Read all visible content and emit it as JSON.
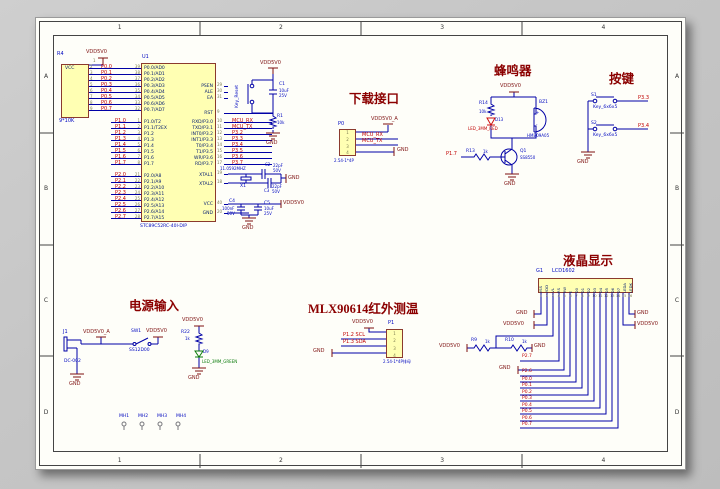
{
  "sheet": {
    "zones_top": [
      "1",
      "2",
      "3",
      "4"
    ],
    "zones_bottom": [
      "1",
      "2",
      "3",
      "4"
    ],
    "zones_left": [
      "A",
      "B",
      "C",
      "D"
    ],
    "zones_right": [
      "A",
      "B",
      "C",
      "D"
    ]
  },
  "colors": {
    "wire": "#0000A6",
    "power": "#7D1010",
    "net": "#C00000",
    "designator": "#0008C0",
    "body_fill": "#FFFFB3",
    "body_border": "#8B3A2E",
    "title": "#8B0000"
  },
  "titles": {
    "download": "下载接口",
    "buzzer": "蜂鸣器",
    "keys": "按键",
    "lcd": "液晶显示",
    "mlx": "MLX90614红外测温",
    "power": "电源输入"
  },
  "mcu": {
    "designator": "U1",
    "part": "STC89C52RC-40I-DIP",
    "p0": [
      {
        "num": "39",
        "name": "P0.0/AD0",
        "net": "P0.0"
      },
      {
        "num": "38",
        "name": "P0.1/AD1",
        "net": "P0.1"
      },
      {
        "num": "37",
        "name": "P0.2/AD2",
        "net": "P0.2"
      },
      {
        "num": "36",
        "name": "P0.3/AD3",
        "net": "P0.3"
      },
      {
        "num": "35",
        "name": "P0.4/AD4",
        "net": "P0.4"
      },
      {
        "num": "34",
        "name": "P0.5/AD5",
        "net": "P0.5"
      },
      {
        "num": "33",
        "name": "P0.6/AD6",
        "net": "P0.6"
      },
      {
        "num": "32",
        "name": "P0.7/AD7",
        "net": "P0.7"
      }
    ],
    "p1": [
      {
        "num": "1",
        "name": "P1.0/T2",
        "net": "P1.0"
      },
      {
        "num": "2",
        "name": "P1.1/T2EX",
        "net": "P1.1"
      },
      {
        "num": "3",
        "name": "P1.2",
        "net": "P1.2"
      },
      {
        "num": "4",
        "name": "P1.3",
        "net": "P1.3"
      },
      {
        "num": "5",
        "name": "P1.4",
        "net": "P1.4"
      },
      {
        "num": "6",
        "name": "P1.5",
        "net": "P1.5"
      },
      {
        "num": "7",
        "name": "P1.6",
        "net": "P1.6"
      },
      {
        "num": "8",
        "name": "P1.7",
        "net": "P1.7"
      }
    ],
    "p2": [
      {
        "num": "21",
        "name": "P2.0/A8",
        "net": "P2.0"
      },
      {
        "num": "22",
        "name": "P2.1/A9",
        "net": "P2.1"
      },
      {
        "num": "23",
        "name": "P2.2/A10",
        "net": "P2.2"
      },
      {
        "num": "24",
        "name": "P2.3/A11",
        "net": "P2.3"
      },
      {
        "num": "25",
        "name": "P2.4/A12",
        "net": "P2.4"
      },
      {
        "num": "26",
        "name": "P2.5/A13",
        "net": "P2.5"
      },
      {
        "num": "27",
        "name": "P2.6/A14",
        "net": "P2.6"
      },
      {
        "num": "28",
        "name": "P2.7/A15",
        "net": "P2.7"
      }
    ],
    "ctrl": [
      {
        "num": "29",
        "name": "PSEN"
      },
      {
        "num": "30",
        "name": "ALE"
      },
      {
        "num": "31",
        "name": "EA"
      }
    ],
    "rst": {
      "num": "9",
      "name": "RST"
    },
    "p3": [
      {
        "num": "10",
        "name": "RXD/P3.0",
        "net": "MCU_RX"
      },
      {
        "num": "11",
        "name": "TXD/P3.1",
        "net": "MCU_TX"
      },
      {
        "num": "12",
        "name": "INT0/P3.2",
        "net": "P3.2"
      },
      {
        "num": "13",
        "name": "INT1/P3.3",
        "net": "P3.3"
      },
      {
        "num": "14",
        "name": "T0/P3.4",
        "net": "P3.4"
      },
      {
        "num": "15",
        "name": "T1/P3.5",
        "net": "P3.5"
      },
      {
        "num": "16",
        "name": "WR/P3.6",
        "net": "P3.6"
      },
      {
        "num": "17",
        "name": "RD/P3.7",
        "net": "P3.7"
      }
    ],
    "xtal": [
      {
        "num": "19",
        "name": "XTAL1"
      },
      {
        "num": "18",
        "name": "XTAL2"
      }
    ],
    "pwr": [
      {
        "num": "40",
        "name": "VCC"
      },
      {
        "num": "20",
        "name": "GND"
      }
    ]
  },
  "rpack": {
    "designator": "R4",
    "common_label": "VCC",
    "common_pin": "1",
    "value": "9*10K",
    "pin_nums": [
      "2",
      "3",
      "4",
      "5",
      "6",
      "7",
      "8",
      "9"
    ],
    "power": "VDD5V0"
  },
  "reset": {
    "key_name": "Key_Reset",
    "power": "VDD5V0",
    "cap": {
      "ref": "C1",
      "value": "10uF",
      "volt": "25V"
    },
    "res": {
      "ref": "R1",
      "value": "10k"
    },
    "gnd": "GND"
  },
  "xtal": {
    "ref": "X1",
    "freq": "11.0592MHZ",
    "c_top": {
      "ref": "C2",
      "value": "22pF",
      "volt": "50V"
    },
    "c_bot": {
      "ref": "C3",
      "value": "22pF",
      "volt": "50V"
    },
    "gnd": "GND"
  },
  "decouple": {
    "power": "VDD5V0",
    "c1": {
      "ref": "C4",
      "value": "100nF",
      "volt": "50V"
    },
    "c2": {
      "ref": "C5",
      "value": "10uF",
      "volt": "25V"
    },
    "gnd": "GND"
  },
  "download": {
    "ref": "P0",
    "pins": [
      "1",
      "2",
      "3",
      "4"
    ],
    "footprint": "2.54-1*4P",
    "power": "VDD5V0_A",
    "net_rx": "MCU_RX",
    "net_tx": "MCU_TX",
    "gnd": "GND"
  },
  "buzzer": {
    "power": "VDD5V0",
    "r_top": {
      "ref": "R14",
      "value": "10k"
    },
    "led": {
      "ref": "D13",
      "name": "LED_3MM_RED"
    },
    "bz": {
      "ref": "BZ1",
      "part": "HMB09A05",
      "plus": "+",
      "minus": "-"
    },
    "q": {
      "ref": "Q1",
      "part": "SS8550"
    },
    "r_base": {
      "ref": "R13",
      "value": "1k"
    },
    "net": "P1.7",
    "gnd": "GND"
  },
  "keys": {
    "items": [
      {
        "ref": "S1",
        "part": "Key_6x6x5",
        "net": "P3.3"
      },
      {
        "ref": "S2",
        "part": "Key_6x6x5",
        "net": "P3.4"
      }
    ],
    "gnd": "GND"
  },
  "lcd": {
    "designator": "G1",
    "part": "LCD1602",
    "pins": [
      {
        "num": "1",
        "name": "VSS"
      },
      {
        "num": "2",
        "name": "VDD"
      },
      {
        "num": "3",
        "name": "VL"
      },
      {
        "num": "4",
        "name": "RS"
      },
      {
        "num": "5",
        "name": "RW"
      },
      {
        "num": "6",
        "name": "E"
      },
      {
        "num": "7",
        "name": "D0"
      },
      {
        "num": "8",
        "name": "D1"
      },
      {
        "num": "9",
        "name": "D2"
      },
      {
        "num": "10",
        "name": "D3"
      },
      {
        "num": "11",
        "name": "D4"
      },
      {
        "num": "12",
        "name": "D5"
      },
      {
        "num": "13",
        "name": "D6"
      },
      {
        "num": "14",
        "name": "D7"
      },
      {
        "num": "15",
        "name": "LEDA"
      },
      {
        "num": "16",
        "name": "LEDK"
      }
    ],
    "gnd_left": "GND",
    "pwr_left": "VDD5V0",
    "gnd_right": "GND",
    "pwr_right": "VDD5V0",
    "divider": {
      "power": "VDD5V0",
      "r1": {
        "ref": "R9",
        "value": "1k"
      },
      "r2": {
        "ref": "R10",
        "value": "1k"
      },
      "gnd": "GND"
    },
    "net_rs": "P2.7",
    "rw_gnd": "GND",
    "net_e": "P2.6",
    "data_nets": [
      "P0.0",
      "P0.1",
      "P0.2",
      "P0.3",
      "P0.4",
      "P0.5",
      "P0.6",
      "P0.7"
    ]
  },
  "mlx": {
    "ref": "P1",
    "pins": [
      "1",
      "2",
      "3",
      "4"
    ],
    "power": "VDD5V0",
    "net_scl": "P1.2 SCL",
    "net_sda": "P1.3 SDA",
    "gnd": "GND",
    "footprint": "2.54-1*4P排母"
  },
  "power_in": {
    "jack": {
      "ref": "J1",
      "part": "DC-002"
    },
    "net_a": "VDD5V0_A",
    "sw": {
      "ref": "SW1",
      "part": "SS12D00"
    },
    "power": "VDD5V0",
    "gnd": "GND",
    "led": {
      "power": "VDD5V0",
      "r": {
        "ref": "R22",
        "value": "1k"
      },
      "d": {
        "ref": "D9",
        "name": "LED_3MM_GREEN"
      },
      "gnd": "GND"
    }
  },
  "holes": [
    "MH1",
    "MH2",
    "MH3",
    "MH4"
  ]
}
